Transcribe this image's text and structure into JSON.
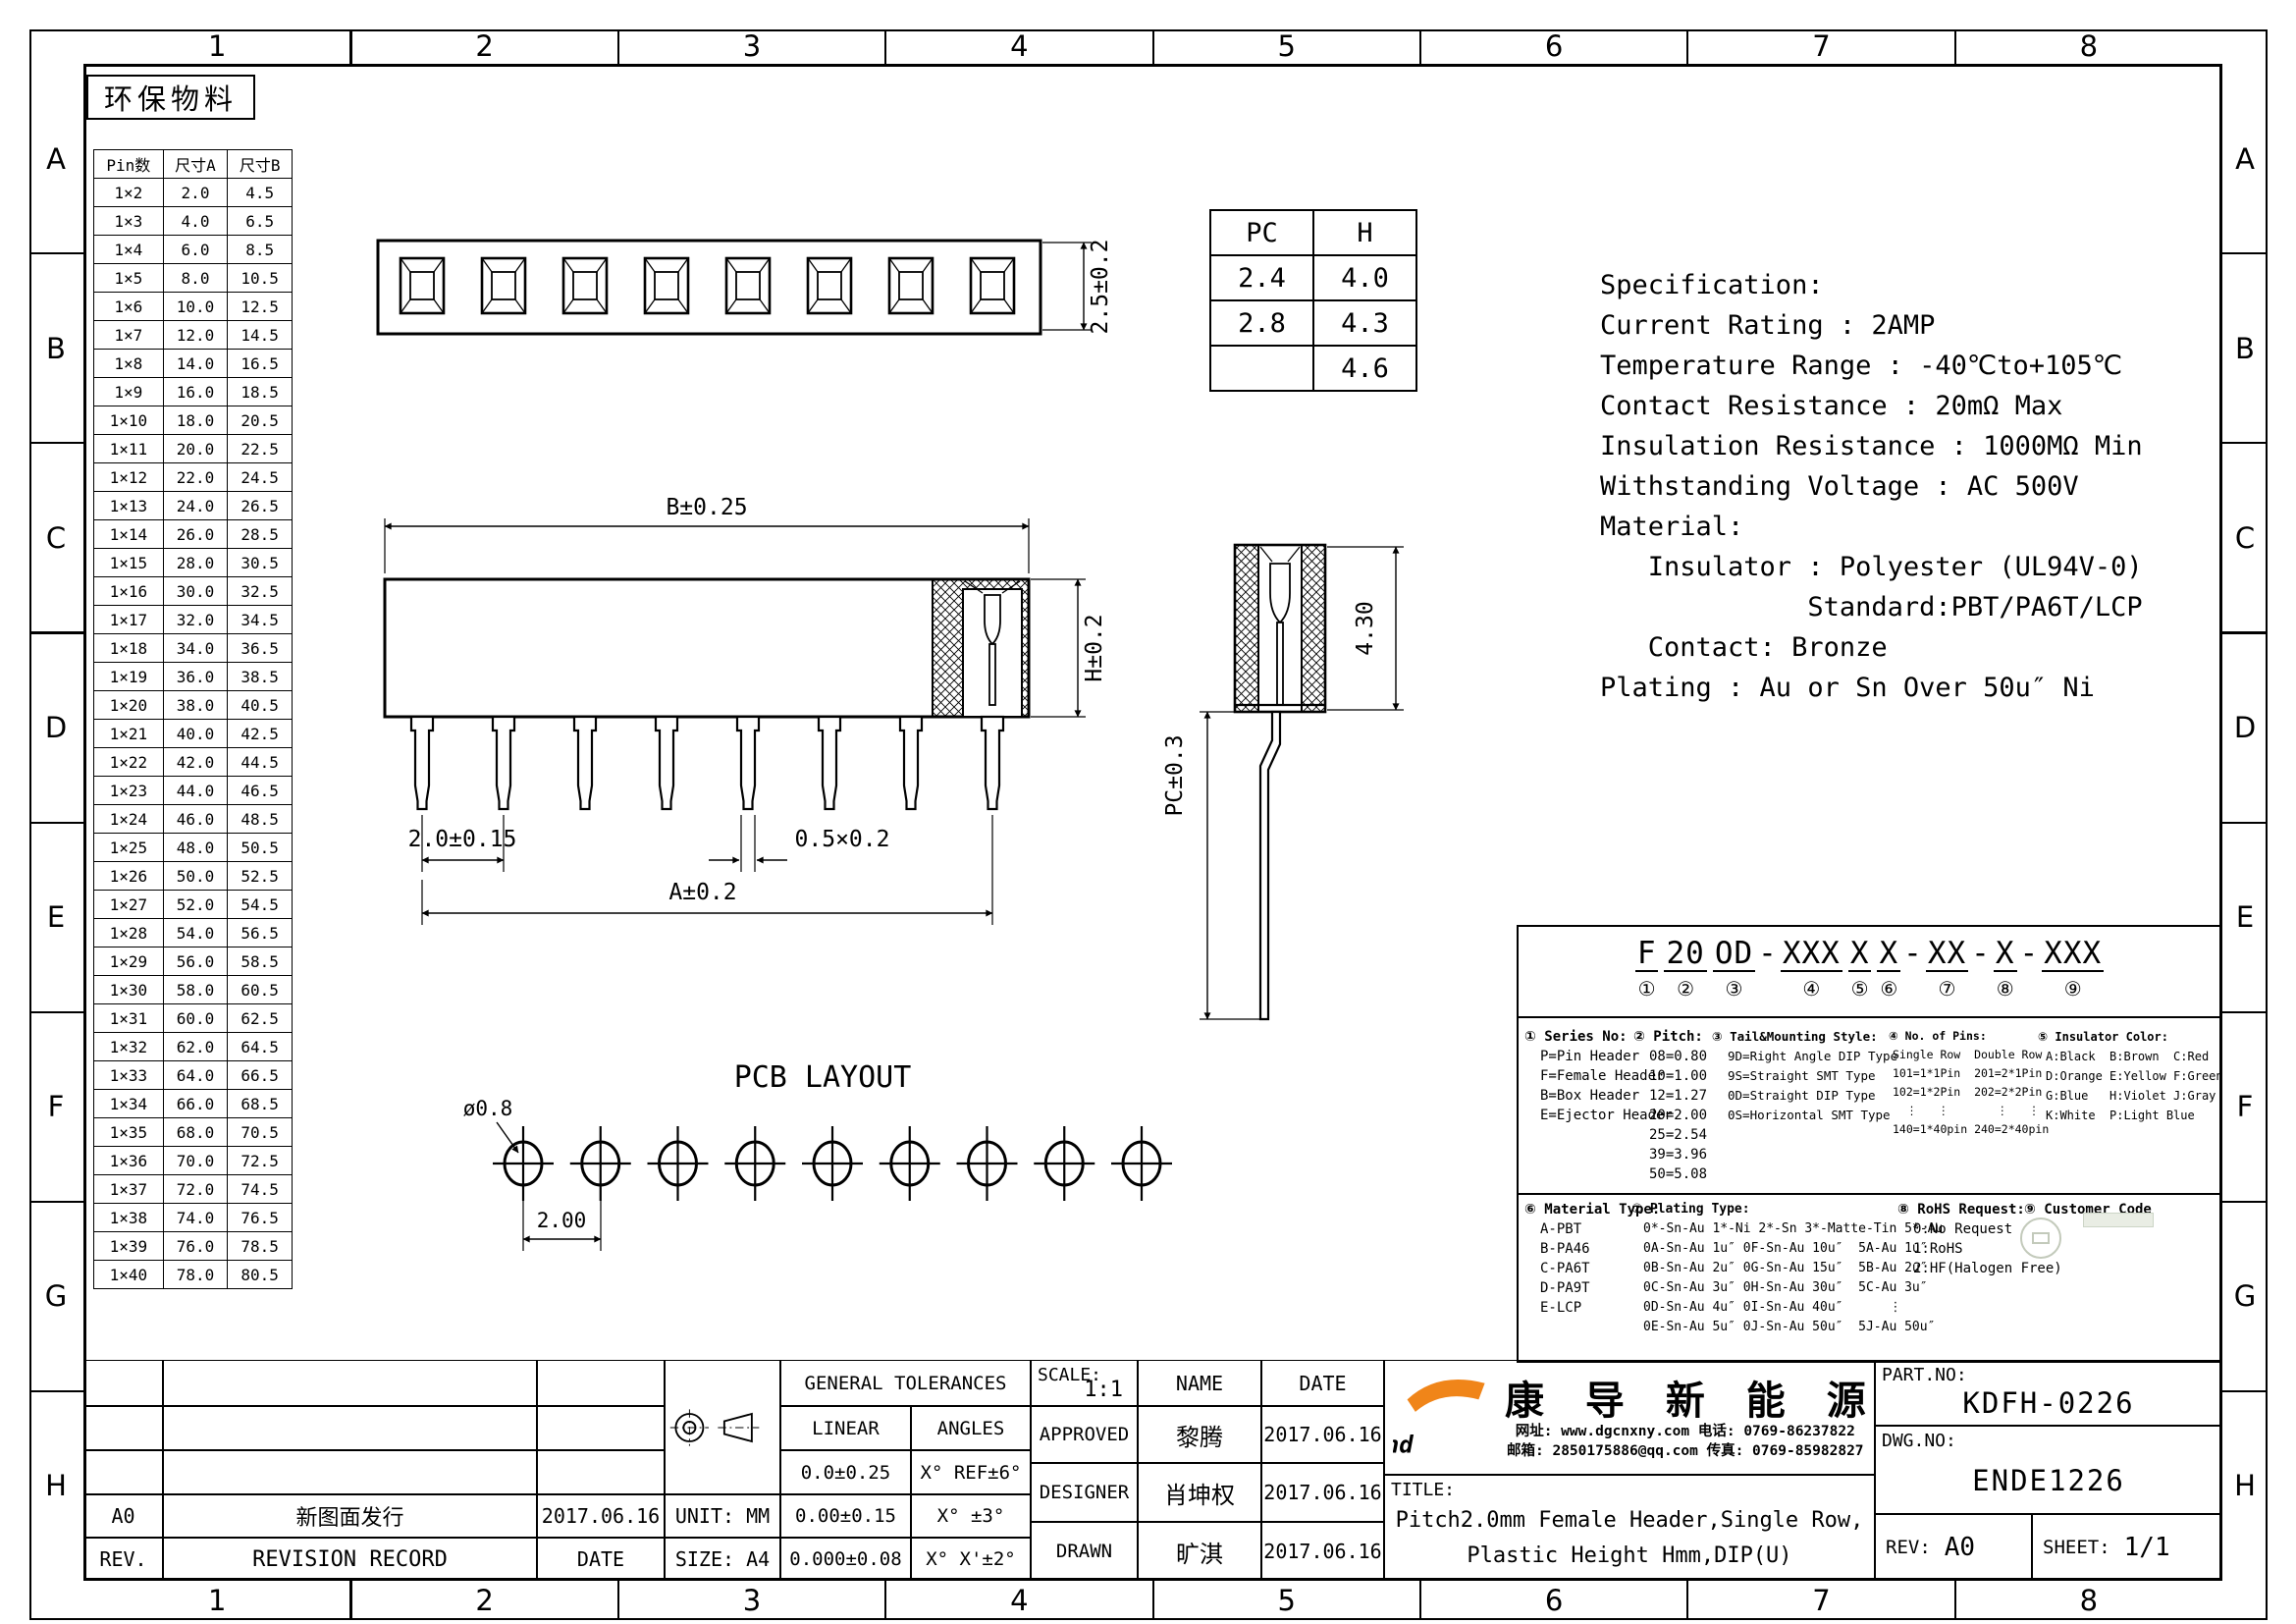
{
  "zones": {
    "cols": [
      "1",
      "2",
      "3",
      "4",
      "5",
      "6",
      "7",
      "8"
    ],
    "rows": [
      "A",
      "B",
      "C",
      "D",
      "E",
      "F",
      "G",
      "H"
    ]
  },
  "eco_label": "环保物料",
  "pin_table": {
    "headers": [
      "Pin数",
      "尺寸A",
      "尺寸B"
    ],
    "rows": [
      [
        "1×2",
        "2.0",
        "4.5"
      ],
      [
        "1×3",
        "4.0",
        "6.5"
      ],
      [
        "1×4",
        "6.0",
        "8.5"
      ],
      [
        "1×5",
        "8.0",
        "10.5"
      ],
      [
        "1×6",
        "10.0",
        "12.5"
      ],
      [
        "1×7",
        "12.0",
        "14.5"
      ],
      [
        "1×8",
        "14.0",
        "16.5"
      ],
      [
        "1×9",
        "16.0",
        "18.5"
      ],
      [
        "1×10",
        "18.0",
        "20.5"
      ],
      [
        "1×11",
        "20.0",
        "22.5"
      ],
      [
        "1×12",
        "22.0",
        "24.5"
      ],
      [
        "1×13",
        "24.0",
        "26.5"
      ],
      [
        "1×14",
        "26.0",
        "28.5"
      ],
      [
        "1×15",
        "28.0",
        "30.5"
      ],
      [
        "1×16",
        "30.0",
        "32.5"
      ],
      [
        "1×17",
        "32.0",
        "34.5"
      ],
      [
        "1×18",
        "34.0",
        "36.5"
      ],
      [
        "1×19",
        "36.0",
        "38.5"
      ],
      [
        "1×20",
        "38.0",
        "40.5"
      ],
      [
        "1×21",
        "40.0",
        "42.5"
      ],
      [
        "1×22",
        "42.0",
        "44.5"
      ],
      [
        "1×23",
        "44.0",
        "46.5"
      ],
      [
        "1×24",
        "46.0",
        "48.5"
      ],
      [
        "1×25",
        "48.0",
        "50.5"
      ],
      [
        "1×26",
        "50.0",
        "52.5"
      ],
      [
        "1×27",
        "52.0",
        "54.5"
      ],
      [
        "1×28",
        "54.0",
        "56.5"
      ],
      [
        "1×29",
        "56.0",
        "58.5"
      ],
      [
        "1×30",
        "58.0",
        "60.5"
      ],
      [
        "1×31",
        "60.0",
        "62.5"
      ],
      [
        "1×32",
        "62.0",
        "64.5"
      ],
      [
        "1×33",
        "64.0",
        "66.5"
      ],
      [
        "1×34",
        "66.0",
        "68.5"
      ],
      [
        "1×35",
        "68.0",
        "70.5"
      ],
      [
        "1×36",
        "70.0",
        "72.5"
      ],
      [
        "1×37",
        "72.0",
        "74.5"
      ],
      [
        "1×38",
        "74.0",
        "76.5"
      ],
      [
        "1×39",
        "76.0",
        "78.5"
      ],
      [
        "1×40",
        "78.0",
        "80.5"
      ]
    ]
  },
  "pch_table": {
    "headers": [
      "PC",
      "H"
    ],
    "rows": [
      [
        "2.4",
        "4.0"
      ],
      [
        "2.8",
        "4.3"
      ],
      [
        "",
        "4.6"
      ]
    ]
  },
  "views": {
    "top": {
      "dim_height": "2.5±0.2"
    },
    "front": {
      "dim_width": "B±0.25",
      "dim_height": "H±0.2",
      "dim_pitch": "2.0±0.15",
      "dim_pin": "0.5×0.2",
      "dim_span": "A±0.2"
    },
    "side": {
      "dim_height": "4.30",
      "dim_pc": "PC±0.3"
    },
    "pcb": {
      "title": "PCB LAYOUT",
      "dim_hole": "ø0.8",
      "dim_pitch": "2.00"
    }
  },
  "specification": {
    "lines": [
      "Specification:",
      "Current Rating : 2AMP",
      "Temperature Range : -40℃to+105℃",
      "Contact Resistance : 20mΩ Max",
      "Insulation Resistance : 1000MΩ Min",
      "Withstanding Voltage : AC 500V",
      "Material:",
      "   Insulator : Polyester (UL94V-0)",
      "             Standard:PBT/PA6T/LCP",
      "   Contact: Bronze",
      "Plating : Au or Sn Over 50u″ Ni"
    ]
  },
  "ordering": {
    "segments": [
      {
        "t": "F",
        "m": "①"
      },
      {
        "t": "20",
        "m": "②"
      },
      {
        "t": "OD",
        "m": "③"
      },
      {
        "d": "-"
      },
      {
        "t": "XXX",
        "m": "④"
      },
      {
        "t": "X",
        "m": "⑤"
      },
      {
        "t": "X",
        "m": "⑥"
      },
      {
        "d": "-"
      },
      {
        "t": "XX",
        "m": "⑦"
      },
      {
        "d": "-"
      },
      {
        "t": "X",
        "m": "⑧"
      },
      {
        "d": "-"
      },
      {
        "t": "XXX",
        "m": "⑨"
      }
    ],
    "blocks": [
      {
        "heading": "① Series No:",
        "lines": [
          "P=Pin Header",
          "F=Female Header",
          "B=Box Header",
          "E=Ejector Header"
        ]
      },
      {
        "heading": "② Pitch:",
        "lines": [
          "08=0.80",
          "10=1.00",
          "12=1.27",
          "20=2.00",
          "25=2.54",
          "39=3.96",
          "50=5.08"
        ]
      },
      {
        "heading": "③ Tail&Mounting Style:",
        "lines": [
          "9D=Right Angle DIP Type",
          "9S=Straight SMT Type",
          "0D=Straight DIP Type",
          "0S=Horizontal SMT Type"
        ]
      },
      {
        "heading": "④ No. of Pins:",
        "lines": [
          "Single Row  Double Row",
          "101=1*1Pin  201=2*1Pin",
          "102=1*2Pin  202=2*2Pin",
          "  ⋮   ⋮       ⋮   ⋮",
          "140=1*40pin 240=2*40pin"
        ]
      },
      {
        "heading": "⑤ Insulator Color:",
        "lines": [
          "A:Black  B:Brown  C:Red",
          "D:Orange E:Yellow F:Green",
          "G:Blue   H:Violet J:Gray",
          "K:White  P:Light Blue"
        ]
      },
      {
        "heading": "⑥ Material Type:",
        "lines": [
          "A-PBT",
          "B-PA46",
          "C-PA6T",
          "D-PA9T",
          "E-LCP"
        ]
      },
      {
        "heading": "⑦ Plating Type:",
        "lines": [
          "0*-Sn-Au 1*-Ni 2*-Sn 3*-Matte-Tin 5*-Au",
          "0A-Sn-Au 1u″ 0F-Sn-Au 10u″  5A-Au 1u″",
          "0B-Sn-Au 2u″ 0G-Sn-Au 15u″  5B-Au 2u″",
          "0C-Sn-Au 3u″ 0H-Sn-Au 30u″  5C-Au 3u″",
          "0D-Sn-Au 4u″ 0I-Sn-Au 40u″      ⋮",
          "0E-Sn-Au 5u″ 0J-Sn-Au 50u″  5J-Au 50u″"
        ]
      },
      {
        "heading": "⑧ RoHS Request:",
        "lines": [
          "0:No Request",
          "1:RoHS",
          "2:HF(Halogen Free)"
        ]
      },
      {
        "heading": "⑨ Customer Code",
        "lines": []
      }
    ]
  },
  "title_block": {
    "revision": {
      "rows": [
        [
          "A0",
          "新图面发行",
          "2017.06.16"
        ],
        [
          "REV.",
          "REVISION RECORD",
          "DATE"
        ]
      ]
    },
    "unit": "UNIT: MM",
    "size": "SIZE: A4",
    "tolerances": {
      "title": "GENERAL TOLERANCES",
      "headers": [
        "LINEAR",
        "ANGLES"
      ],
      "rows": [
        [
          "0.0±0.25",
          "X° REF±6°"
        ],
        [
          "0.00±0.15",
          "X° ±3°"
        ],
        [
          "0.000±0.08",
          "X° X'±2°"
        ]
      ]
    },
    "scale_label": "SCALE:",
    "scale_value": "1:1",
    "name_header": "NAME",
    "date_header": "DATE",
    "approvals": [
      [
        "APPROVED",
        "黎腾",
        "2017.06.16"
      ],
      [
        "DESIGNER",
        "肖坤权",
        "2017.06.16"
      ],
      [
        "DRAWN",
        "旷淇",
        "2017.06.16"
      ]
    ],
    "company": {
      "name": "康 导 新 能 源",
      "logo_text": "hd",
      "contact1": "网址: www.dgcnxny.com  电话: 0769-86237822",
      "contact2": "邮箱: 2850175886@qq.com 传真: 0769-85982827",
      "logo_blue": "#2BA7DF",
      "logo_orange": "#F08519"
    },
    "title_label": "TITLE:",
    "title_lines": [
      "Pitch2.0mm Female Header,Single Row,",
      "Plastic Height Hmm,DIP(U)"
    ],
    "part_no_label": "PART.NO:",
    "part_no": "KDFH-0226",
    "dwg_no_label": "DWG.NO:",
    "dwg_no": "ENDE1226",
    "rev_label": "REV:",
    "rev": "A0",
    "sheet_label": "SHEET:",
    "sheet": "1/1"
  }
}
